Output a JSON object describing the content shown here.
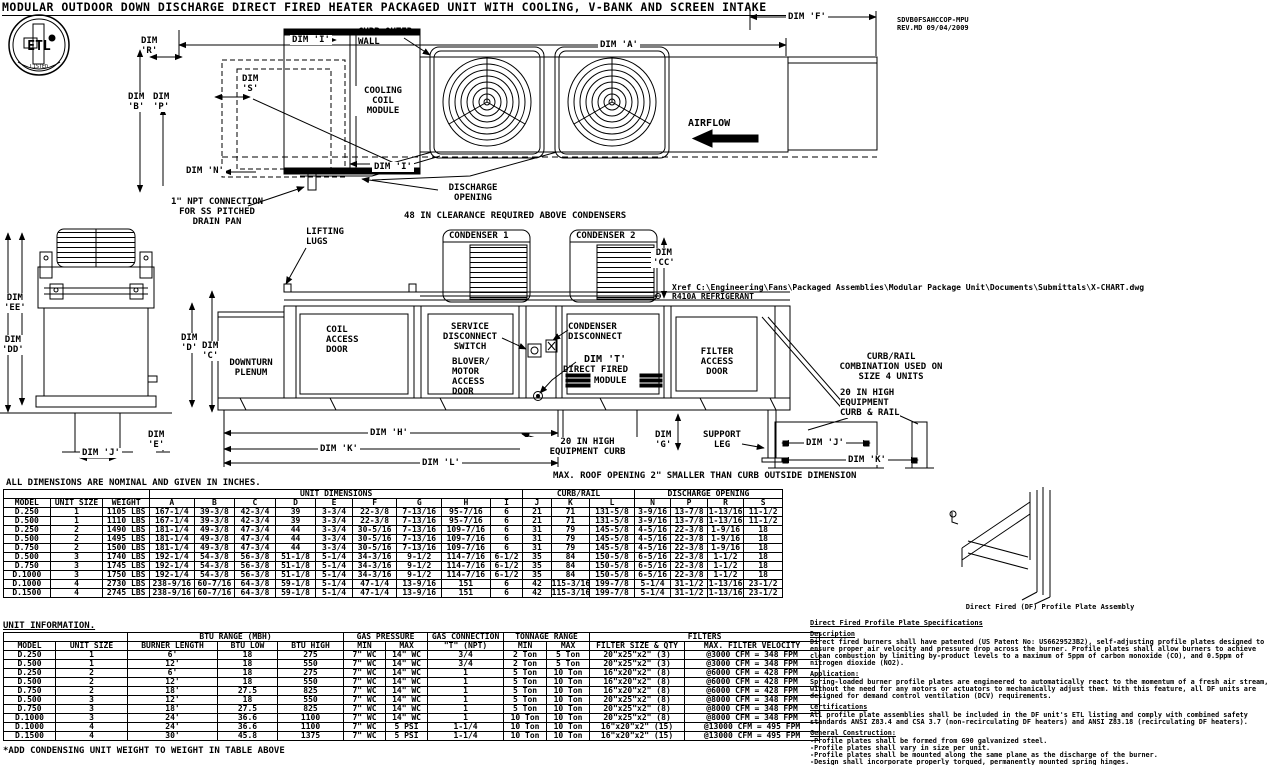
{
  "title": "MODULAR OUTDOOR DOWN DISCHARGE DIRECT FIRED HEATER PACKAGED UNIT WITH COOLING, V-BANK AND SCREEN INTAKE",
  "doc_ref": "SDVB0FSAHCCOP-MPU\nREV.MD  09/04/2009",
  "logo": {
    "text": "ETL",
    "listed": "LISTED"
  },
  "top_view": {
    "dim_a": "DIM 'A'",
    "dim_f": "DIM 'F'",
    "dim_b": "DIM\n'B'",
    "dim_p": "DIM\n'P'",
    "dim_r": "DIM\n'R'",
    "dim_s": "DIM\n'S'",
    "dim_n": "DIM 'N'",
    "dim_i_top": "DIM 'I'",
    "dim_i_bottom": "DIM 'I'",
    "curb_outer_wall": "CURB OUTER\nWALL",
    "cooling_coil_module": "COOLING\nCOIL\nMODULE",
    "airflow": "AIRFLOW",
    "discharge_opening": "DISCHARGE\nOPENING",
    "npt_note": "1\" NPT CONNECTION\nFOR SS PITCHED\nDRAIN PAN",
    "clearance_note": "48 IN CLEARANCE REQUIRED ABOVE CONDENSERS"
  },
  "side_view": {
    "lifting_lugs": "LIFTING\nLUGS",
    "condenser1": "CONDENSER 1",
    "condenser2": "CONDENSER 2",
    "dim_cc": "DIM\n'CC'",
    "dim_ee": "DIM\n'EE'",
    "dim_dd": "DIM\n'DD'",
    "dim_j_left": "DIM 'J'",
    "dim_e": "DIM\n'E'",
    "dim_d": "DIM\n'D'",
    "dim_c": "DIM\n'C'",
    "downturn_plenum": "DOWNTURN\nPLENUM",
    "coil_access_door": "COIL\nACCESS\nDOOR",
    "service_disconnect": "SERVICE\nDISCONNECT\nSWITCH",
    "blower_motor_access": "BLOVER/\nMOTOR\nACCESS\nDOOR",
    "condenser_disconnect": "CONDENSER\nDISCONNECT",
    "dim_t": "DIM 'T'",
    "direct_fired_line1": "DIRECT FIRED",
    "direct_fired_line2": "MODULE",
    "filter_access_door": "FILTER\nACCESS\nDOOR",
    "dim_h": "DIM 'H'",
    "dim_k": "DIM 'K'",
    "dim_l": "DIM 'L'",
    "equipment_curb": "20 IN HIGH\nEQUIPMENT CURB",
    "dim_g": "DIM\n'G'",
    "support_leg": "SUPPORT\nLEG",
    "xref": "Xref C:\\Engineering\\Fans\\Packaged Assemblies\\Modular Package Unit\\Documents\\Submittals\\X-CHART.dwg",
    "refrigerant": "R410A REFRIGERANT",
    "curb_rail_combo": "CURB/RAIL\nCOMBINATION USED ON\nSIZE 4 UNITS",
    "curb_rail_20": "20 IN HIGH\nEQUIPMENT\nCURB & RAIL",
    "dim_j_right": "DIM 'J'",
    "dim_k_right": "DIM 'K'",
    "roof_note": "MAX. ROOF OPENING 2\" SMALLER THAN CURB OUTSIDE DIMENSION"
  },
  "assembly_caption": "Direct Fired (DF) Profile Plate Assembly",
  "tables": {
    "dimensions": {
      "note": "ALL DIMENSIONS ARE NOMINAL AND GIVEN IN INCHES.",
      "groups": [
        {
          "label": "",
          "span": 3
        },
        {
          "label": "UNIT DIMENSIONS",
          "span": 9
        },
        {
          "label": "CURB/RAIL",
          "span": 3
        },
        {
          "label": "DISCHARGE OPENING",
          "span": 4
        }
      ],
      "headers": [
        "MODEL",
        "UNIT SIZE",
        "WEIGHT",
        "A",
        "B",
        "C",
        "D",
        "E",
        "F",
        "G",
        "H",
        "I",
        "J",
        "K",
        "L",
        "N",
        "P",
        "R",
        "S"
      ],
      "rows": [
        [
          "D.250",
          "1",
          "1105 LBS",
          "167-1/4",
          "39-3/8",
          "42-3/4",
          "39",
          "3-3/4",
          "22-3/8",
          "7-13/16",
          "95-7/16",
          "6",
          "21",
          "71",
          "131-5/8",
          "3-9/16",
          "13-7/8",
          "1-13/16",
          "11-1/2"
        ],
        [
          "D.500",
          "1",
          "1110 LBS",
          "167-1/4",
          "39-3/8",
          "42-3/4",
          "39",
          "3-3/4",
          "22-3/8",
          "7-13/16",
          "95-7/16",
          "6",
          "21",
          "71",
          "131-5/8",
          "3-9/16",
          "13-7/8",
          "1-13/16",
          "11-1/2"
        ],
        [
          "D.250",
          "2",
          "1490 LBS",
          "181-1/4",
          "49-3/8",
          "47-3/4",
          "44",
          "3-3/4",
          "30-5/16",
          "7-13/16",
          "109-7/16",
          "6",
          "31",
          "79",
          "145-5/8",
          "4-5/16",
          "22-3/8",
          "1-9/16",
          "18"
        ],
        [
          "D.500",
          "2",
          "1495 LBS",
          "181-1/4",
          "49-3/8",
          "47-3/4",
          "44",
          "3-3/4",
          "30-5/16",
          "7-13/16",
          "109-7/16",
          "6",
          "31",
          "79",
          "145-5/8",
          "4-5/16",
          "22-3/8",
          "1-9/16",
          "18"
        ],
        [
          "D.750",
          "2",
          "1500 LBS",
          "181-1/4",
          "49-3/8",
          "47-3/4",
          "44",
          "3-3/4",
          "30-5/16",
          "7-13/16",
          "109-7/16",
          "6",
          "31",
          "79",
          "145-5/8",
          "4-5/16",
          "22-3/8",
          "1-9/16",
          "18"
        ],
        [
          "D.500",
          "3",
          "1740 LBS",
          "192-1/4",
          "54-3/8",
          "56-3/8",
          "51-1/8",
          "5-1/4",
          "34-3/16",
          "9-1/2",
          "114-7/16",
          "6-1/2",
          "35",
          "84",
          "150-5/8",
          "6-5/16",
          "22-3/8",
          "1-1/2",
          "18"
        ],
        [
          "D.750",
          "3",
          "1745 LBS",
          "192-1/4",
          "54-3/8",
          "56-3/8",
          "51-1/8",
          "5-1/4",
          "34-3/16",
          "9-1/2",
          "114-7/16",
          "6-1/2",
          "35",
          "84",
          "150-5/8",
          "6-5/16",
          "22-3/8",
          "1-1/2",
          "18"
        ],
        [
          "D.1000",
          "3",
          "1750 LBS",
          "192-1/4",
          "54-3/8",
          "56-3/8",
          "51-1/8",
          "5-1/4",
          "34-3/16",
          "9-1/2",
          "114-7/16",
          "6-1/2",
          "35",
          "84",
          "150-5/8",
          "6-5/16",
          "22-3/8",
          "1-1/2",
          "18"
        ],
        [
          "D.1000",
          "4",
          "2730 LBS",
          "238-9/16",
          "60-7/16",
          "64-3/8",
          "59-1/8",
          "5-1/4",
          "47-1/4",
          "13-9/16",
          "151",
          "6",
          "42",
          "115-3/16",
          "199-7/8",
          "5-1/4",
          "31-1/2",
          "1-13/16",
          "23-1/2"
        ],
        [
          "D.1500",
          "4",
          "2745 LBS",
          "238-9/16",
          "60-7/16",
          "64-3/8",
          "59-1/8",
          "5-1/4",
          "47-1/4",
          "13-9/16",
          "151",
          "6",
          "42",
          "115-3/16",
          "199-7/8",
          "5-1/4",
          "31-1/2",
          "1-13/16",
          "23-1/2"
        ]
      ]
    },
    "unit_info": {
      "title": "UNIT INFORMATION.",
      "groups": [
        {
          "label": "",
          "span": 2
        },
        {
          "label": "BTU RANGE (MBH)",
          "span": 3
        },
        {
          "label": "GAS PRESSURE",
          "span": 2
        },
        {
          "label": "GAS CONNECTION",
          "span": 1
        },
        {
          "label": "TONNAGE RANGE",
          "span": 2
        },
        {
          "label": "FILTERS",
          "span": 2
        }
      ],
      "headers": [
        "MODEL",
        "UNIT SIZE",
        "BURNER LENGTH",
        "BTU LOW",
        "BTU HIGH",
        "MIN",
        "MAX",
        "\"T\" (NPT)",
        "MIN",
        "MAX",
        "FILTER SIZE & QTY",
        "MAX. FILTER VELOCITY"
      ],
      "rows": [
        [
          "D.250",
          "1",
          "6'",
          "18",
          "275",
          "7\" WC",
          "14\" WC",
          "3/4",
          "2 Ton",
          "5 Ton",
          "20\"x25\"x2\" (3)",
          "@3000 CFM = 348 FPM"
        ],
        [
          "D.500",
          "1",
          "12'",
          "18",
          "550",
          "7\" WC",
          "14\" WC",
          "3/4",
          "2 Ton",
          "5 Ton",
          "20\"x25\"x2\" (3)",
          "@3000 CFM = 348 FPM"
        ],
        [
          "D.250",
          "2",
          "6'",
          "18",
          "275",
          "7\" WC",
          "14\" WC",
          "1",
          "5 Ton",
          "10 Ton",
          "16\"x20\"x2\" (8)",
          "@6000 CFM = 428 FPM"
        ],
        [
          "D.500",
          "2",
          "12'",
          "18",
          "550",
          "7\" WC",
          "14\" WC",
          "1",
          "5 Ton",
          "10 Ton",
          "16\"x20\"x2\" (8)",
          "@6000 CFM = 428 FPM"
        ],
        [
          "D.750",
          "2",
          "18'",
          "27.5",
          "825",
          "7\" WC",
          "14\" WC",
          "1",
          "5 Ton",
          "10 Ton",
          "16\"x20\"x2\" (8)",
          "@6000 CFM = 428 FPM"
        ],
        [
          "D.500",
          "3",
          "12'",
          "18",
          "550",
          "7\" WC",
          "14\" WC",
          "1",
          "5 Ton",
          "10 Ton",
          "20\"x25\"x2\" (8)",
          "@8000 CFM = 348 FPM"
        ],
        [
          "D.750",
          "3",
          "18'",
          "27.5",
          "825",
          "7\" WC",
          "14\" WC",
          "1",
          "5 Ton",
          "10 Ton",
          "20\"x25\"x2\" (8)",
          "@8000 CFM = 348 FPM"
        ],
        [
          "D.1000",
          "3",
          "24'",
          "36.6",
          "1100",
          "7\" WC",
          "14\" WC",
          "1",
          "10 Ton",
          "10 Ton",
          "20\"x25\"x2\" (8)",
          "@8000 CFM = 348 FPM"
        ],
        [
          "D.1000",
          "4",
          "24'",
          "36.6",
          "1100",
          "7\" WC",
          "5 PSI",
          "1-1/4",
          "10 Ton",
          "10 Ton",
          "16\"x20\"x2\" (15)",
          "@13000 CFM = 495 FPM"
        ],
        [
          "D.1500",
          "4",
          "30'",
          "45.8",
          "1375",
          "7\" WC",
          "5 PSI",
          "1-1/4",
          "10 Ton",
          "10 Ton",
          "16\"x20\"x2\" (15)",
          "@13000 CFM = 495 FPM"
        ]
      ],
      "footnote": "*ADD CONDENSING UNIT WEIGHT TO WEIGHT IN TABLE ABOVE"
    }
  },
  "specs": {
    "title": "Direct Fired Profile Plate Specifications",
    "sections": [
      {
        "heading": "Description",
        "body": "Direct fired burners shall have patented (US Patent No: US6629523B2), self-adjusting profile plates designed to ensure proper air velocity and pressure drop across the burner. Profile plates shall allow burners to achieve clean combustion by limiting by-product levels to a maximum of 5ppm of carbon monoxide (CO), and 0.5ppm of nitrogen dioxide (NO2)."
      },
      {
        "heading": "Application:",
        "body": "Spring-loaded burner profile plates are engineered to automatically react to the momentum of a fresh air stream, without the need for any motors or actuators to mechanically adjust them. With this feature, all DF units are designed for demand control ventilation (DCV) requirements."
      },
      {
        "heading": "Certifications",
        "body": "All profile plate assemblies shall be included in the DF unit's ETL listing and comply with combined safety standards ANSI Z83.4 and CSA 3.7 (non-recirculating DF heaters) and ANSI Z83.18 (recirculating DF heaters)."
      },
      {
        "heading": "General Construction:",
        "body": "-Profile plates shall be formed from G90 galvanized steel.\n-Profile plates shall vary in size per unit.\n-Profile plates shall be mounted along the same plane as the discharge of the burner.\n-Design shall incorporate properly torqued, permanently mounted spring hinges.\n-Spring hinges shall be made from plated steel."
      }
    ]
  }
}
